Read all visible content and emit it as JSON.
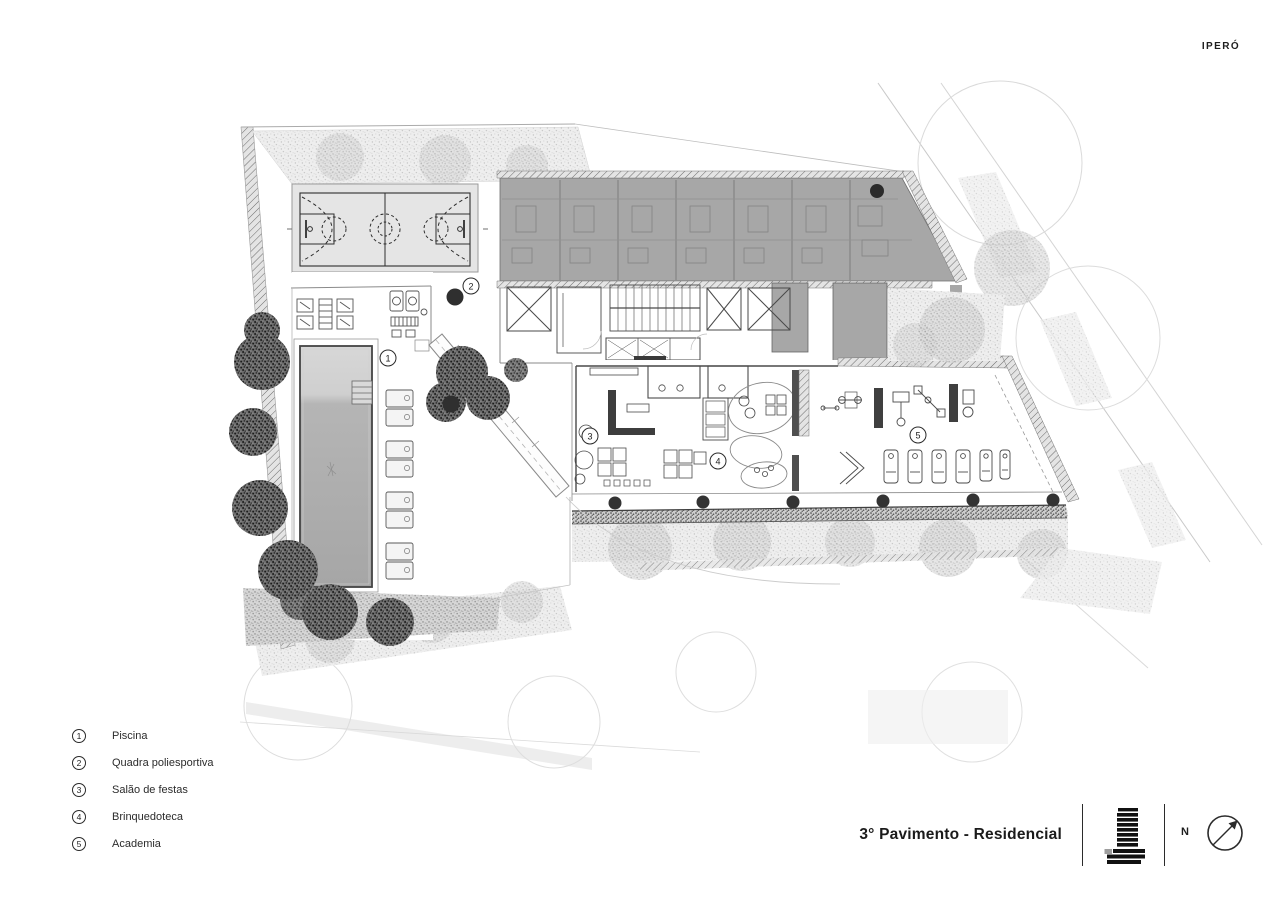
{
  "brand": {
    "logo": "IPERÓ"
  },
  "sheet": {
    "title": "3° Pavimento - Residencial",
    "north_label": "N"
  },
  "legend": {
    "items": [
      {
        "number": "1",
        "label": "Piscina"
      },
      {
        "number": "2",
        "label": "Quadra poliesportiva"
      },
      {
        "number": "3",
        "label": "Salão de festas"
      },
      {
        "number": "4",
        "label": "Brinquedoteca"
      },
      {
        "number": "5",
        "label": "Academia"
      }
    ]
  },
  "plan_markers": [
    {
      "number": "1"
    },
    {
      "number": "2"
    },
    {
      "number": "3"
    },
    {
      "number": "4"
    },
    {
      "number": "5"
    }
  ],
  "colors": {
    "unit_wing_fill": "#a7a7a7",
    "court_fill": "#e5e5e5",
    "pool_water": "#adadad",
    "ink": "#1e1e1e"
  }
}
